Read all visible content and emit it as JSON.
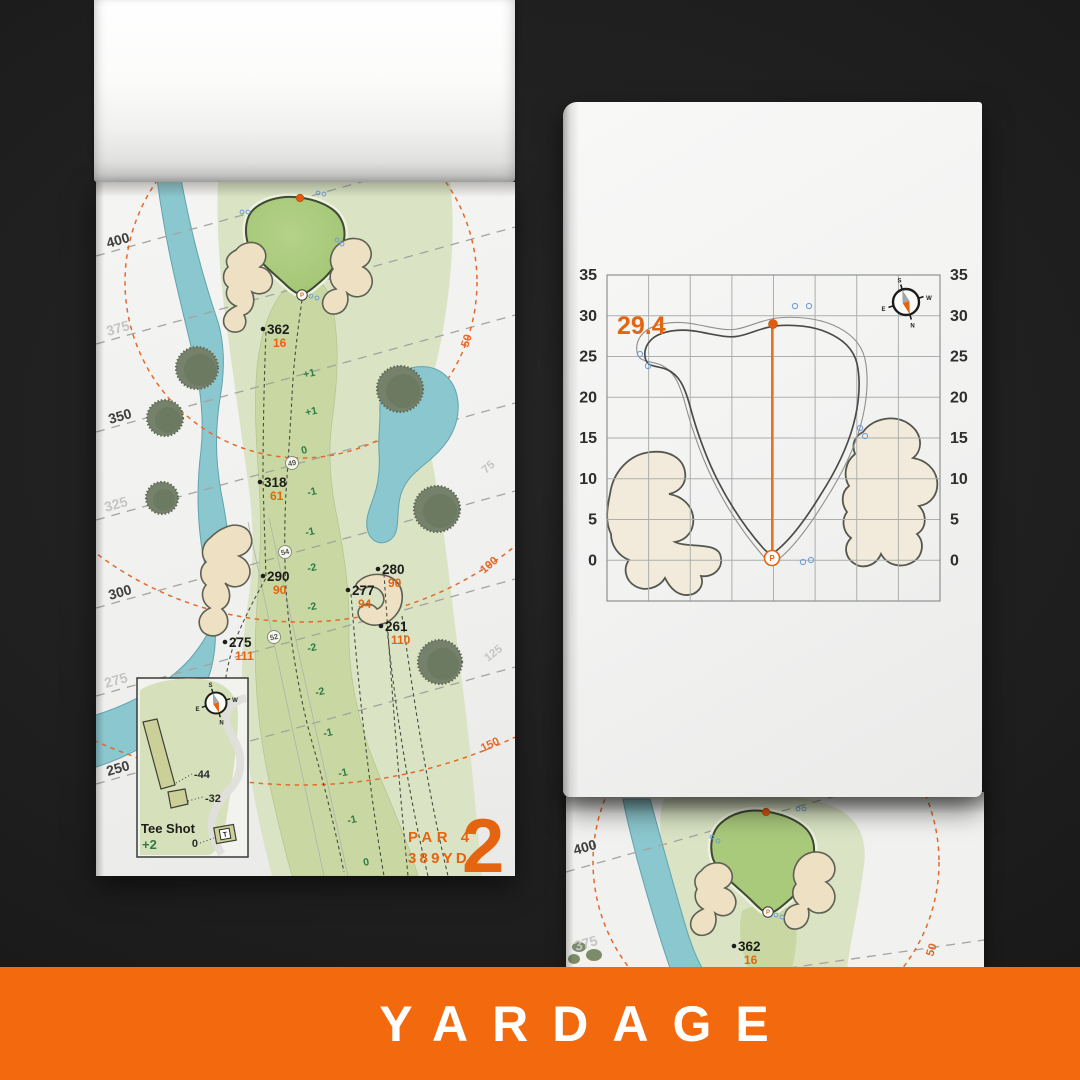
{
  "colors": {
    "background": "#1E1E1E",
    "banner_orange": "#F2690E",
    "accent_orange": "#E5640F",
    "fairway_green": "#C9D8A2",
    "rough_green": "#DAE4C4",
    "putting_green": "#A9C97B",
    "water_blue": "#8BC7CE",
    "sand": "#EDE0C3",
    "elevation_green": "#2F7A46"
  },
  "banner": {
    "label": "YARDAGE"
  },
  "compass": {
    "n": "N",
    "e": "E",
    "s": "S",
    "w": "W"
  },
  "left_page": {
    "hole_number": "2",
    "par_label": "PAR 4",
    "yardage_label": "389YD",
    "distance_labels": [
      "400",
      "375",
      "350",
      "325",
      "300",
      "275",
      "250"
    ],
    "arc_labels": [
      "50",
      "100",
      "150"
    ],
    "side_labels": [
      "75",
      "125"
    ],
    "points": [
      {
        "carry": "362",
        "to_green": "16"
      },
      {
        "carry": "318",
        "to_green": "61"
      },
      {
        "carry": "290",
        "to_green": "90"
      },
      {
        "carry": "280",
        "to_green": "90"
      },
      {
        "carry": "277",
        "to_green": "94"
      },
      {
        "carry": "261",
        "to_green": "110"
      },
      {
        "carry": "275",
        "to_green": "111"
      }
    ],
    "elevation_labels": [
      "+1",
      "+1",
      "0",
      "-1",
      "-1",
      "-2",
      "-2",
      "-2",
      "-2",
      "-1",
      "-1",
      "-1",
      "0"
    ],
    "circled_labels": [
      "49",
      "54",
      "52"
    ],
    "pin_label": "P",
    "tee_inset": {
      "title": "Tee Shot",
      "elevation": "+2",
      "back_tee_offset": "-44",
      "forward_tee_offset": "-32",
      "zero_label": "0",
      "tee_marker": "T"
    }
  },
  "right_page": {
    "pin_depth": "29.4",
    "axis_labels": [
      "35",
      "30",
      "25",
      "20",
      "15",
      "10",
      "5",
      "0"
    ],
    "pin_label": "P"
  },
  "bottom_page": {
    "distance_labels": [
      "400",
      "375"
    ],
    "arc_label": "50",
    "point": {
      "carry": "362",
      "to_green": "16"
    },
    "pin_label": "P"
  }
}
